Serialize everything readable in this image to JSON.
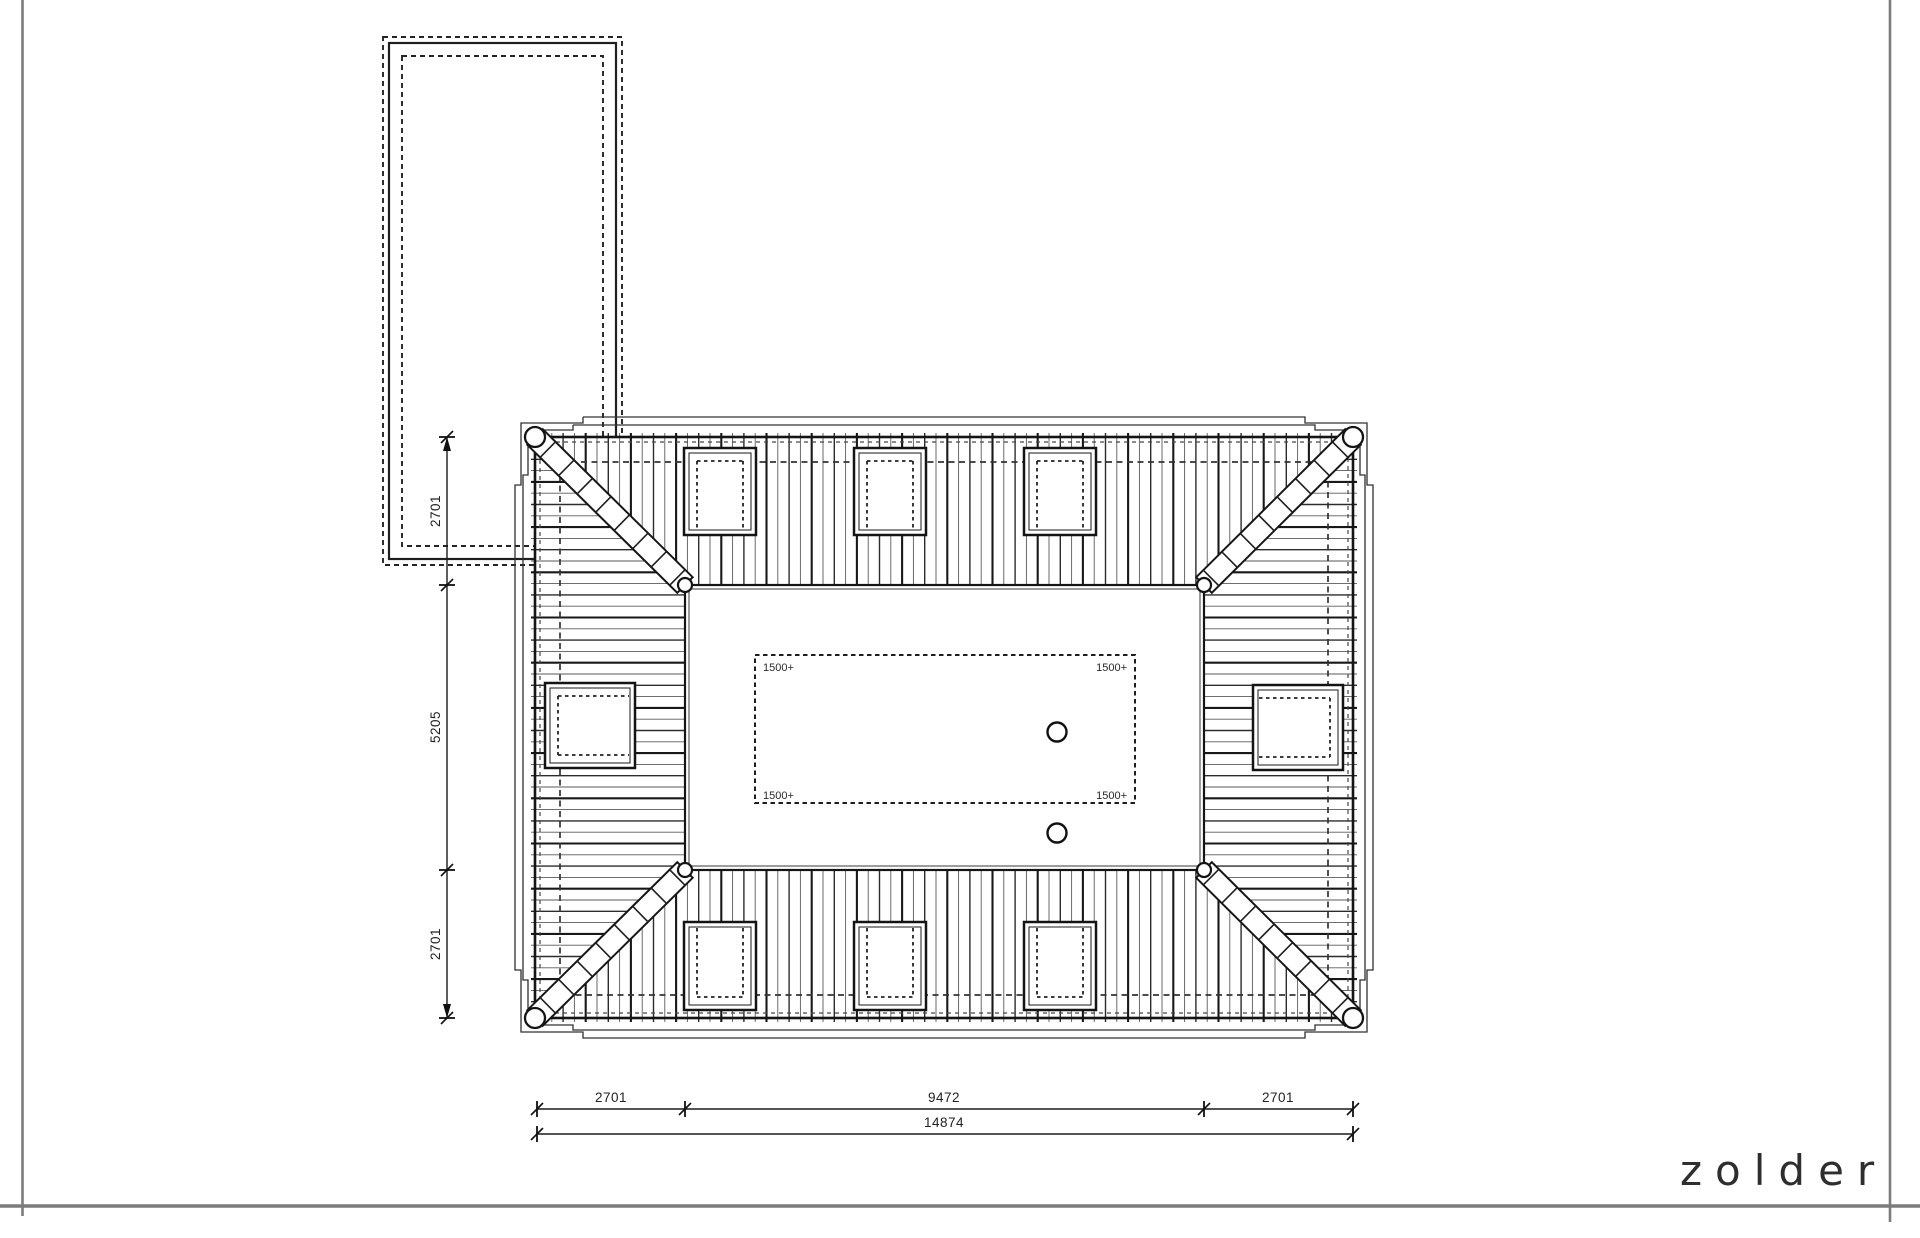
{
  "title": {
    "label": "zolder"
  },
  "dimensions": {
    "left": [
      {
        "value": "2701"
      },
      {
        "value": "5205"
      },
      {
        "value": "2701"
      }
    ],
    "bottom": [
      {
        "value": "2701"
      },
      {
        "value": "9472"
      },
      {
        "value": "2701"
      }
    ],
    "bottom_total": {
      "value": "14874"
    }
  },
  "annotations": {
    "headroom_labels": [
      "1500+",
      "1500+",
      "1500+",
      "1500+"
    ]
  },
  "colors": {
    "line": "#1a1a1a",
    "frame": "#7c7c7c",
    "hatch_light": "#5a5a5a"
  }
}
